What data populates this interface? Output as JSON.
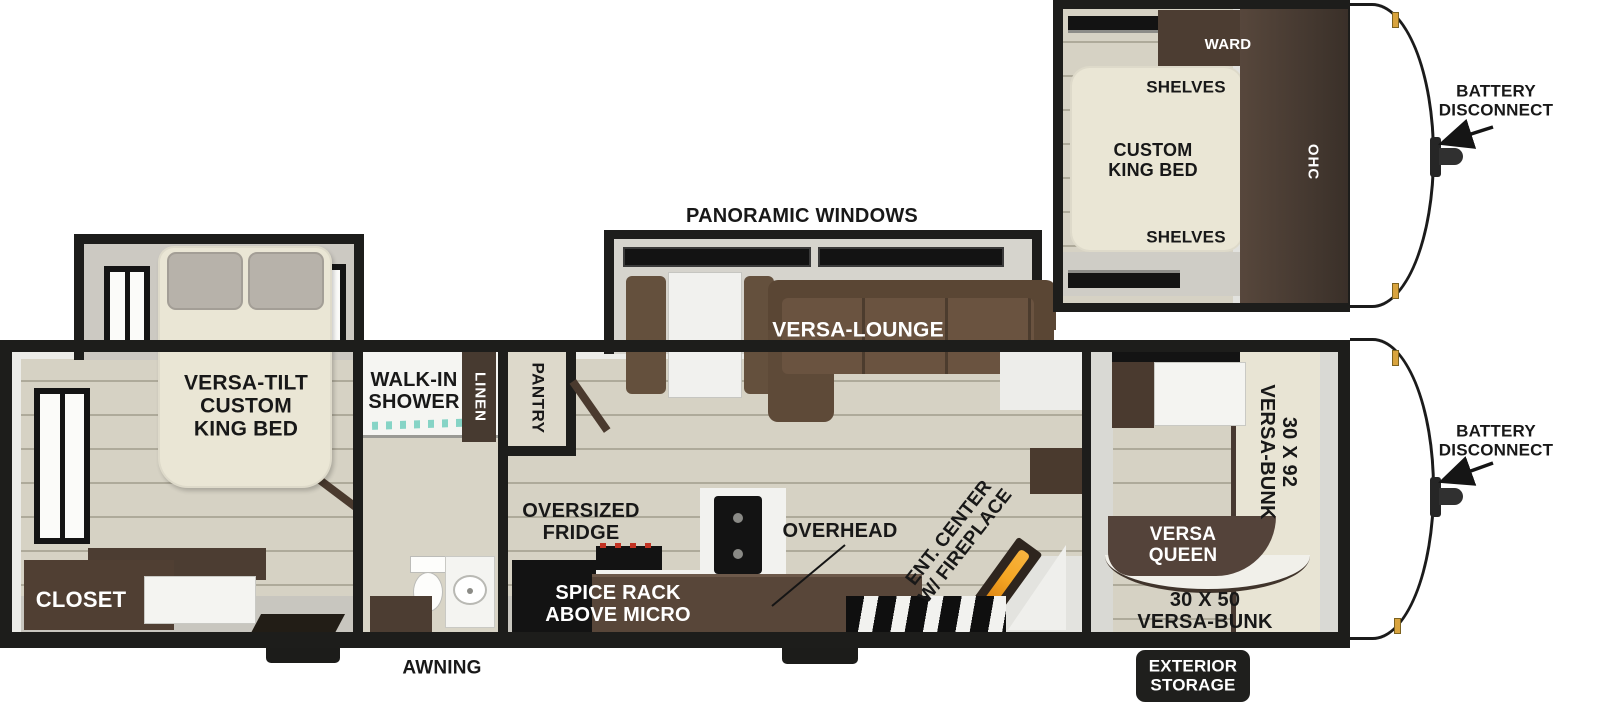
{
  "title": "Travel trailer floor plan",
  "colors": {
    "wall": "#1d1d1b",
    "floor": "#d6d2c4",
    "plank_line": "#6e6856",
    "slide_floor": "#cdcbc4",
    "walkway": "#c8c6bf",
    "furniture_brown": "#54433a",
    "counter_brown": "#584639",
    "sofa_brown": "#6a5340",
    "appliance_black": "#131313",
    "bed_cream": "#eae6d5",
    "pillow_gray": "#b7b2aa",
    "label_black": "#181818",
    "label_white": "#ffffff",
    "flame_orange": "#f5a623",
    "shower_teal": "#86d4c6",
    "hinge_gold": "#d9a43e"
  },
  "inset": {
    "ward": "WARD",
    "shelves_top": "SHELVES",
    "custom_king_bed": "CUSTOM\nKING BED",
    "ohc": "OHC",
    "shelves_bottom": "SHELVES",
    "battery_disconnect": "BATTERY\nDISCONNECT"
  },
  "main": {
    "panoramic_windows": "PANORAMIC WINDOWS",
    "versa_lounge": "VERSA-LOUNGE",
    "versa_tilt_king_bed": "VERSA-TILT\nCUSTOM\nKING BED",
    "closet": "CLOSET",
    "walk_in_shower": "WALK-IN\nSHOWER",
    "linen": "LINEN",
    "pantry": "PANTRY",
    "oversized_fridge": "OVERSIZED\nFRIDGE",
    "spice_rack": "SPICE RACK\nABOVE MICRO",
    "overhead": "OVERHEAD",
    "ent_center": "ENT. CENTER\nW/ FIREPLACE",
    "bunk_30x92": "30 X 92\nVERSA-BUNK",
    "versa_queen": "VERSA\nQUEEN",
    "bunk_30x50": "30 X 50\nVERSA-BUNK",
    "battery_disconnect": "BATTERY\nDISCONNECT",
    "awning": "AWNING",
    "exterior_storage": "EXTERIOR\nSTORAGE"
  }
}
